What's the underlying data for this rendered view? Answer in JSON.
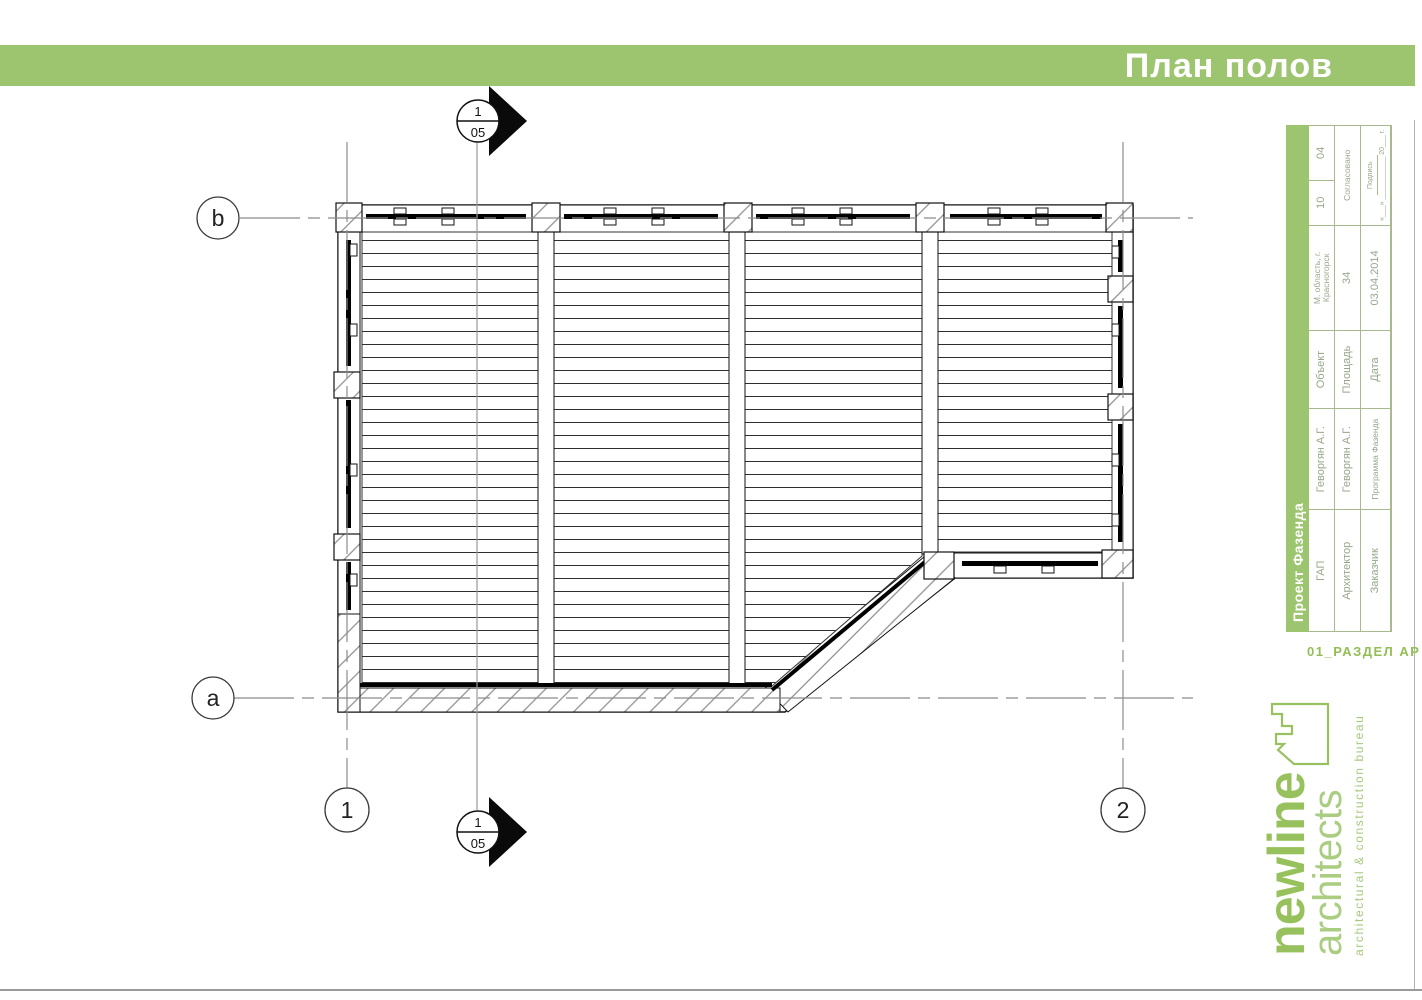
{
  "header": {
    "title": "План полов",
    "accent_color": "#9dc46f"
  },
  "drawing": {
    "grid": {
      "axis_b": "b",
      "axis_a": "a",
      "axis_1": "1",
      "axis_2": "2"
    },
    "section_marker": {
      "number": "1",
      "sheet": "05"
    }
  },
  "title_block": {
    "project": "Проект Фазенда",
    "rows": [
      {
        "label": "ГАП",
        "value": "Геворгян А.Г."
      },
      {
        "label": "Архитектор",
        "value": "Геворгян А.Г."
      },
      {
        "label": "Заказчик",
        "value": "Программа Фазенда"
      }
    ],
    "info": [
      {
        "label": "Объект",
        "value": "М. область, г. Красногорск"
      },
      {
        "label": "Площадь",
        "value": "34"
      },
      {
        "label": "Дата",
        "value": "03.04.2014"
      }
    ],
    "approval": {
      "count_1": "10",
      "count_2": "04",
      "agreed_label": "Согласовано",
      "signature_label": "Подпись",
      "signature_blank": "«___» ___________ 20___ г."
    },
    "section_code": "01_РАЗДЕЛ АР"
  },
  "logo": {
    "name_line1": "newline",
    "name_line2": "architects",
    "tagline": "architectural & construction bureau",
    "brand_color": "#97c15c"
  }
}
